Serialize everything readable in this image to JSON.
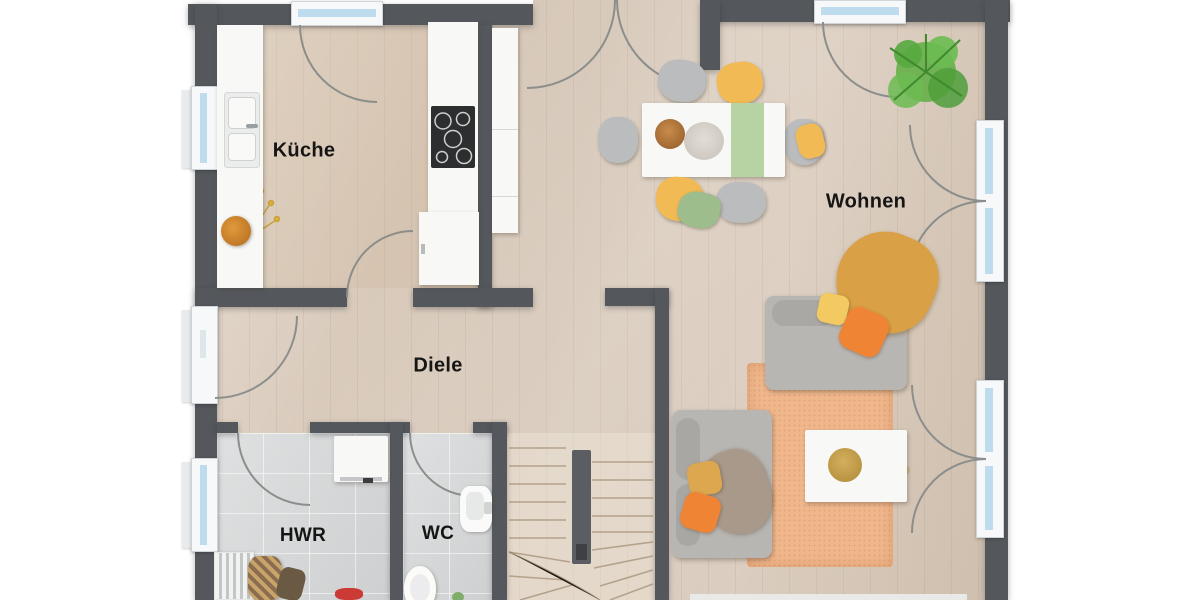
{
  "plan": {
    "type": "floor-plan-top-view",
    "floor_label": "Erdgeschoss (implied, not shown)",
    "language": "de"
  },
  "rooms": [
    {
      "id": "kueche",
      "label": "Küche"
    },
    {
      "id": "wohnen",
      "label": "Wohnen"
    },
    {
      "id": "diele",
      "label": "Diele"
    },
    {
      "id": "hwr",
      "label": "HWR"
    },
    {
      "id": "wc",
      "label": "WC"
    }
  ],
  "colors": {
    "wall": "#54585c",
    "wood_floor": "#d8c9ba",
    "tile_floor": "#d4d6d7",
    "window_glass": "#bedcee",
    "window_frame": "#f6f8f9",
    "door_arc": "#8b8e8b",
    "sofa_gray": "#b8b6b2",
    "chair_gray": "#babcbe",
    "accent_yellow": "#f1ba55",
    "accent_orange": "#ef8434",
    "accent_green": "#9dbd8d",
    "rug_orange": "#f0b78d",
    "throw_mustard": "#d9a045",
    "plant_green": "#64b44a",
    "stairs_wood": "#d9cbb6"
  },
  "furniture_icons": [
    "entry-door-icon",
    "window-icon",
    "french-door-icon",
    "kitchen-counter-icon",
    "kitchen-sink-icon",
    "cooktop-icon",
    "tall-cabinet-icon",
    "fruit-bowl-icon",
    "flower-twig-icon",
    "dining-table-icon",
    "table-runner-icon",
    "dining-chair-icon",
    "potted-plant-icon",
    "sofa-icon",
    "loveseat-icon",
    "coffee-table-icon",
    "rug-icon",
    "sideboard-icon",
    "staircase-icon",
    "washing-machine-icon",
    "laundry-rack-icon",
    "storage-bag-icon",
    "toilet-icon",
    "wash-basin-icon"
  ]
}
